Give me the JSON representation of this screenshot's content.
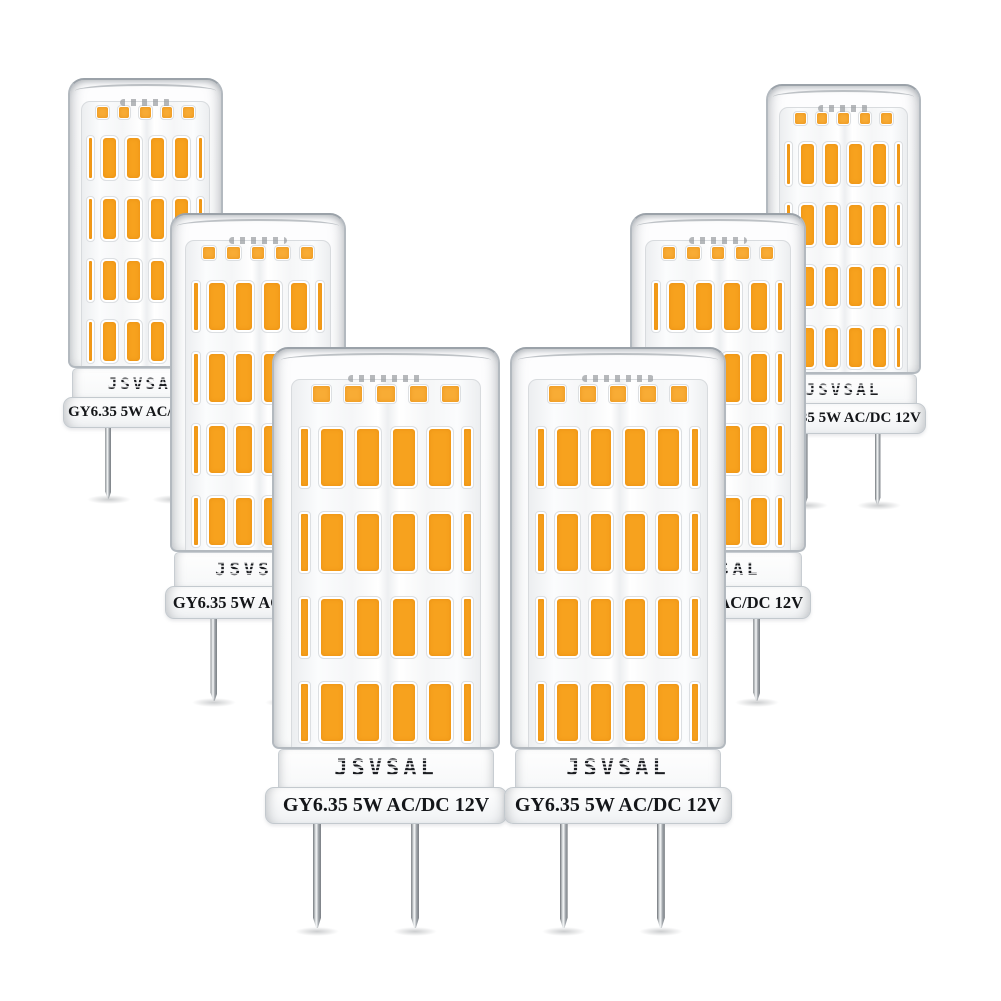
{
  "product": {
    "brand": "JSVSAL",
    "spec": "GY6.35 5W AC/DC 12V"
  },
  "scene": {
    "bulb_count": 6,
    "bulbs": [
      {
        "label": "back-left"
      },
      {
        "label": "back-right"
      },
      {
        "label": "mid-left"
      },
      {
        "label": "mid-right"
      },
      {
        "label": "front-left"
      },
      {
        "label": "front-right"
      }
    ],
    "led_rows_per_bulb": 4,
    "led_chips_per_row": 6
  },
  "colors": {
    "led": "#F7A21E",
    "led_mini": "#F8AC35",
    "glass_outline": "#B3B9BF",
    "base_text": "#141619",
    "background": "#FFFFFF"
  }
}
